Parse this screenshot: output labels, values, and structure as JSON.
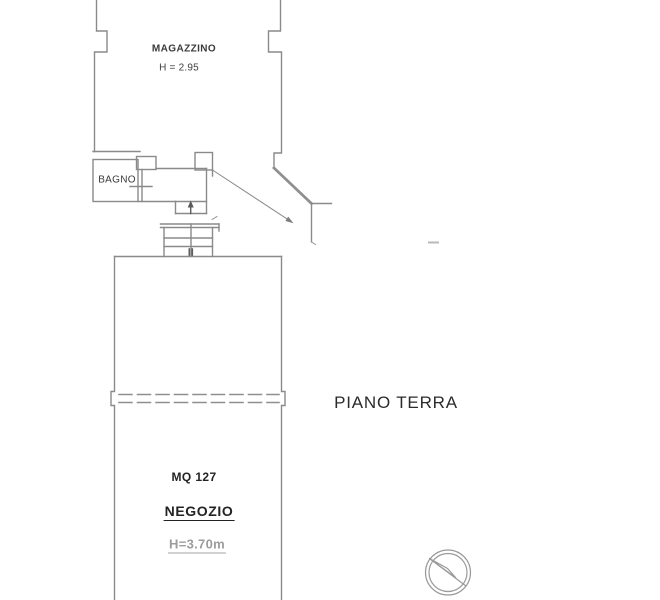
{
  "plan": {
    "floor_label": "PIANO TERRA",
    "rooms": {
      "magazzino": {
        "name": "MAGAZZINO",
        "height_label": "H = 2.95"
      },
      "bagno": {
        "name": "BAGNO"
      },
      "negozio": {
        "area_label": "MQ 127",
        "name": "NEGOZIO",
        "height_label": "H=3.70m"
      }
    },
    "icons": {
      "compass": "north-compass-icon",
      "stairs_direction": "up-arrow-icon"
    },
    "colors": {
      "wall_line": "#8a8a8a",
      "text": "#2b2b2b",
      "muted_text": "#9c9c9c",
      "background": "#ffffff"
    }
  }
}
